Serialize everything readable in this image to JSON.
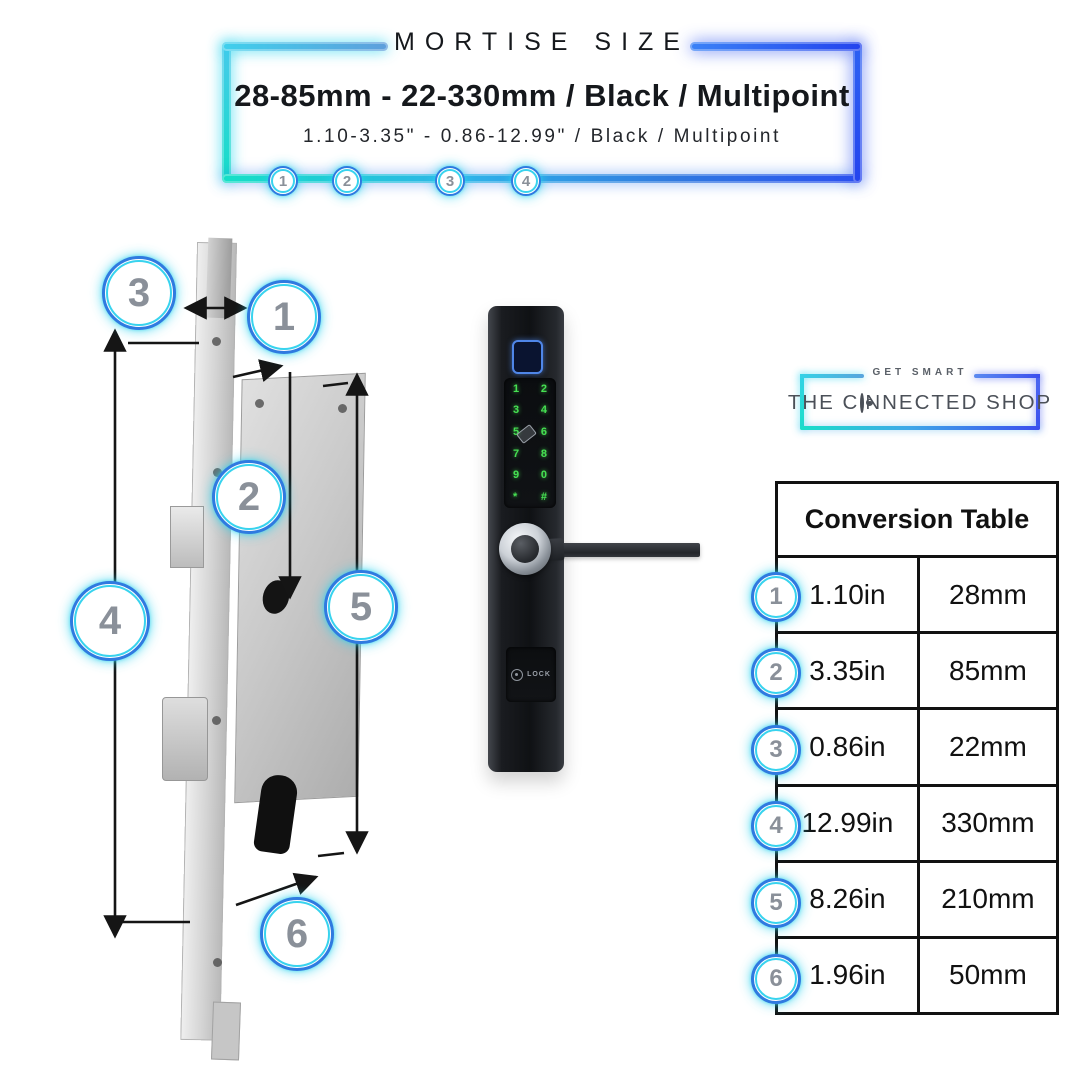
{
  "header": {
    "title": "MORTISE SIZE",
    "headline": "28-85mm - 22-330mm / Black / Multipoint",
    "subheadline": "1.10-3.35\" - 0.86-12.99\" / Black / Multipoint",
    "markers": [
      "1",
      "2",
      "3",
      "4"
    ]
  },
  "diagram": {
    "callouts": [
      "1",
      "2",
      "3",
      "4",
      "5",
      "6"
    ]
  },
  "device": {
    "keypad_rows": [
      [
        "1",
        "2"
      ],
      [
        "3",
        "4"
      ],
      [
        "5",
        "6"
      ],
      [
        "7",
        "8"
      ],
      [
        "9",
        "0"
      ],
      [
        "*",
        "#"
      ]
    ],
    "lock_label": "LOCK"
  },
  "logo": {
    "tagline": "GET SMART",
    "brand_prefix": "THE C",
    "brand_suffix": "NNECTED SHOP"
  },
  "table": {
    "title": "Conversion Table",
    "rows": [
      {
        "num": "1",
        "inches": "1.10in",
        "mm": "28mm"
      },
      {
        "num": "2",
        "inches": "3.35in",
        "mm": "85mm"
      },
      {
        "num": "3",
        "inches": "0.86in",
        "mm": "22mm"
      },
      {
        "num": "4",
        "inches": "12.99in",
        "mm": "330mm"
      },
      {
        "num": "5",
        "inches": "8.26in",
        "mm": "210mm"
      },
      {
        "num": "6",
        "inches": "1.96in",
        "mm": "50mm"
      }
    ]
  },
  "icons": {
    "fingerprint": "fingerprint-icon",
    "card_reader": "card-reader-icon",
    "lock_brand": "lock-brand-icon",
    "connected_o": "connected-o-icon"
  },
  "colors": {
    "accent_teal": "#14dfc6",
    "accent_cyan": "#38d3ee",
    "accent_blue": "#2b50f0",
    "keypad_green": "#46e052",
    "fingerprint_blue": "#4f86e8",
    "number_gray": "#8a9099",
    "table_border": "#111111"
  }
}
